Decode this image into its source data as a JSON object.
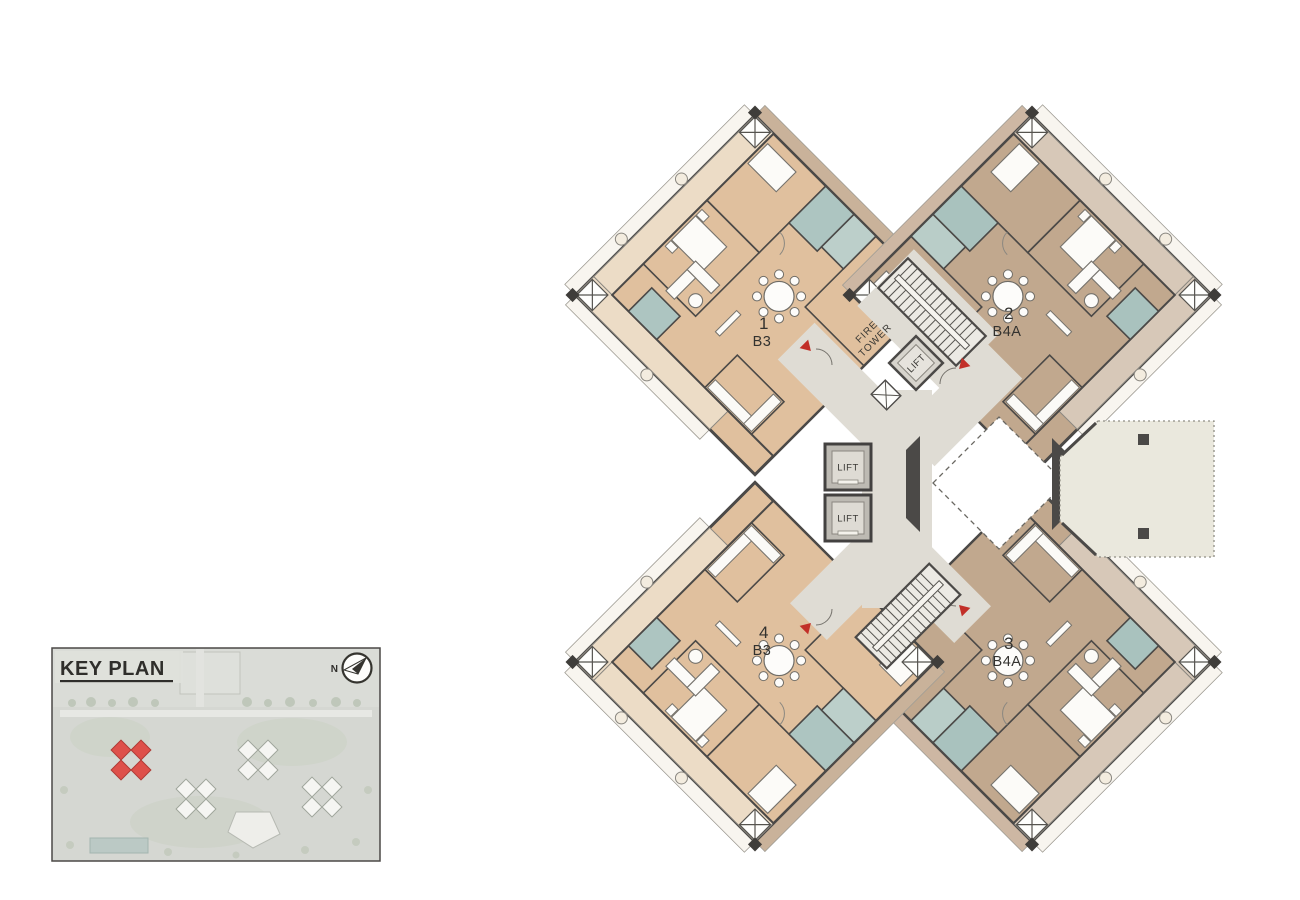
{
  "units": [
    {
      "number": "1",
      "type": "B3"
    },
    {
      "number": "2",
      "type": "B4A"
    },
    {
      "number": "3",
      "type": "B4A"
    },
    {
      "number": "4",
      "type": "B3"
    }
  ],
  "core": {
    "fire_tower_line1": "FIRE",
    "fire_tower_line2": "TOWER",
    "lift_label": "LIFT"
  },
  "key_plan": {
    "title": "KEY PLAN",
    "north_label": "N"
  },
  "colors": {
    "unit_b3": "#e0c09e",
    "unit_b3_balcony": "#ecdcc6",
    "unit_b3_outer_balcony": "#c9b29a",
    "unit_b4a": "#c1a88e",
    "unit_b4a_balcony": "#d7c8b8",
    "unit_b4a_outer_balcony": "#cdb7a3",
    "bathroom": "#adc5c1",
    "corridor": "#dfdcd4",
    "wall": "#4b4947",
    "terrace": "#eae8dd",
    "entrance_marker_red": "#c22f28",
    "key_plan_highlight_red": "#e0423c"
  }
}
